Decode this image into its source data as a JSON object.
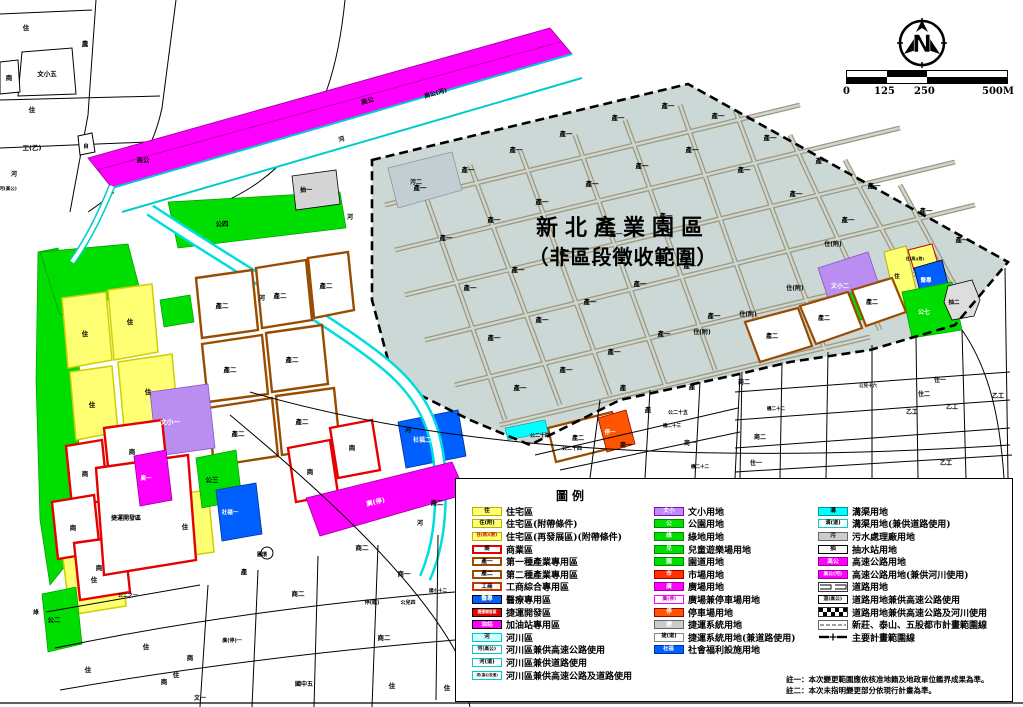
{
  "title": {
    "line1": "新北產業園區",
    "line2": "（非區段徵收範圍）"
  },
  "north_label": "N",
  "scalebar": {
    "ticks": [
      "0",
      "125",
      "250",
      "500M"
    ]
  },
  "notes": [
    "註一：本次變更範圍應依核准地籍及地政單位鑑界成果為準。",
    "註二：本次未指明變更部分依現行計畫為準。"
  ],
  "colors": {
    "residential_yellow": "#ffff73",
    "commercial_red": "#e60000",
    "industrial_brown": "#994c00",
    "park_green": "#00dd00",
    "mrt_magenta": "#ff00ff",
    "welfare_blue": "#0060ff",
    "parking_orange": "#ff5500",
    "river_cyan": "#00dddd",
    "school_purple": "#b98ef0",
    "zone_fill": "#cbd8d6",
    "grid_brown": "#a2987a"
  },
  "legend": {
    "title": "圖例",
    "columns": [
      {
        "items": [
          {
            "c": "住",
            "l": "住宅區",
            "f": "#ffff73",
            "s": "#b3b300",
            "tc": "#000",
            "cs": 6
          },
          {
            "c": "住(附)",
            "l": "住宅區(附帶條件)",
            "f": "#ffff73",
            "s": "#b3b300",
            "tc": "#000",
            "cs": 5.5
          },
          {
            "c": "住(再)(附)",
            "l": "住宅區(再發展區)(附帶條件)",
            "f": "#ffff73",
            "s": "#b3b300",
            "tc": "#c00000",
            "cs": 4.5
          },
          {
            "c": "商",
            "l": "商業區",
            "f": "#ffffff",
            "s": "#e60000",
            "tc": "#000",
            "cs": 6,
            "bw": 2
          },
          {
            "c": "產一",
            "l": "第一種產業專用區",
            "f": "#ffffff",
            "s": "#994c00",
            "tc": "#000",
            "cs": 6,
            "bw": 2
          },
          {
            "c": "產二",
            "l": "第二種產業專用區",
            "f": "#ffffff",
            "s": "#994c00",
            "tc": "#000",
            "cs": 6,
            "bw": 2
          },
          {
            "c": "工商",
            "l": "工商綜合專用區",
            "f": "#ffffff",
            "s": "#cc3300",
            "tc": "#000",
            "cs": 6,
            "bw": 2
          },
          {
            "c": "醫專",
            "l": "醫療專用區",
            "f": "#0060ff",
            "s": "#000000",
            "tc": "#fff",
            "cs": 6
          },
          {
            "c": "捷運開發區",
            "l": "捷運開發區",
            "f": "#e60000",
            "s": "#000000",
            "tc": "#fff",
            "cs": 4
          },
          {
            "c": "油站",
            "l": "加油站專用區",
            "f": "#ff00ff",
            "s": "#000000",
            "tc": "#fff",
            "cs": 6
          },
          {
            "c": "河",
            "l": "河川區",
            "f": "#ccffff",
            "s": "#00cccc",
            "tc": "#000",
            "cs": 6
          },
          {
            "c": "河(高公)",
            "l": "河川區兼供高速公路使用",
            "f": "#ffffff",
            "s": "#00cccc",
            "tc": "#000",
            "cs": 5
          },
          {
            "c": "河(道)",
            "l": "河川區兼供道路使用",
            "f": "#ffffff",
            "s": "#00cccc",
            "tc": "#000",
            "cs": 5.5
          },
          {
            "c": "河(高公及道)",
            "l": "河川區兼供高速公路及道路使用",
            "f": "#ffffff",
            "s": "#00cccc",
            "tc": "#000",
            "cs": 3.8
          }
        ]
      },
      {
        "items": [
          {
            "c": "文小",
            "l": "文小用地",
            "f": "#b98ef0",
            "s": "#8800cc",
            "tc": "#fff",
            "cs": 6
          },
          {
            "c": "公",
            "l": "公園用地",
            "f": "#00dd00",
            "s": "#008800",
            "tc": "#fff",
            "cs": 6
          },
          {
            "c": "綠",
            "l": "綠地用地",
            "f": "#00dd00",
            "s": "#008800",
            "tc": "#fff",
            "cs": 6
          },
          {
            "c": "兒",
            "l": "兒童遊樂場用地",
            "f": "#00dd00",
            "s": "#008800",
            "tc": "#fff",
            "cs": 6
          },
          {
            "c": "園",
            "l": "園道用地",
            "f": "#00dd00",
            "s": "#008800",
            "tc": "#fff",
            "cs": 6
          },
          {
            "c": "市",
            "l": "市場用地",
            "f": "#ff3300",
            "s": "#990000",
            "tc": "#fff",
            "cs": 6
          },
          {
            "c": "廣",
            "l": "廣場用地",
            "f": "#ff00ff",
            "s": "#990099",
            "tc": "#fff",
            "cs": 6
          },
          {
            "c": "廣(停)",
            "l": "廣場兼停車場用地",
            "f": "#ffffff",
            "s": "#ff00ff",
            "tc": "#cc00cc",
            "cs": 5
          },
          {
            "c": "停",
            "l": "停車場用地",
            "f": "#ff5500",
            "s": "#990000",
            "tc": "#fff",
            "cs": 6
          },
          {
            "c": "捷",
            "l": "捷運系統用地",
            "f": "#cccccc",
            "s": "#666666",
            "tc": "#fff",
            "cs": 6
          },
          {
            "c": "捷(道)",
            "l": "捷運系統用地(兼道路使用)",
            "f": "#ffffff",
            "s": "#888888",
            "tc": "#000",
            "cs": 5.5
          },
          {
            "c": "社福",
            "l": "社會福利設施用地",
            "f": "#0060ff",
            "s": "#003399",
            "tc": "#fff",
            "cs": 5.5
          }
        ]
      },
      {
        "items": [
          {
            "c": "溝",
            "l": "溝渠用地",
            "f": "#00ffff",
            "s": "#009999",
            "tc": "#000",
            "cs": 6
          },
          {
            "c": "溝(道)",
            "l": "溝渠用地(兼供道路使用)",
            "f": "#ffffff",
            "s": "#00cccc",
            "tc": "#000",
            "cs": 5.5
          },
          {
            "c": "污",
            "l": "污水處理廠用地",
            "f": "#cccccc",
            "s": "#666666",
            "tc": "#000",
            "cs": 6
          },
          {
            "c": "抽",
            "l": "抽水站用地",
            "f": "#ffffff",
            "s": "#000000",
            "tc": "#000",
            "cs": 6
          },
          {
            "c": "高公",
            "l": "高速公路用地",
            "f": "#ff00ff",
            "s": "#990099",
            "tc": "#fff",
            "cs": 6
          },
          {
            "c": "高公(河)",
            "l": "高速公路用地(兼供河川使用)",
            "f": "#ff00ff",
            "s": "#990099",
            "tc": "#fff",
            "cs": 5
          },
          {
            "type": "road",
            "l": "道路用地"
          },
          {
            "c": "道(高公)",
            "l": "道路用地兼供高速公路使用",
            "f": "#ffffff",
            "s": "#000000",
            "tc": "#000",
            "cs": 5
          },
          {
            "type": "hatch",
            "l": "道路用地兼供高速公路及河川使用"
          },
          {
            "type": "boundary-thin",
            "l": "新莊、泰山、五股都市計畫範圍線"
          },
          {
            "type": "boundary-main",
            "l": "主要計畫範圍線"
          }
        ]
      }
    ]
  },
  "map": {
    "labels": [
      {
        "t": "住",
        "x": 26,
        "y": 30
      },
      {
        "t": "農",
        "x": 85,
        "y": 46
      },
      {
        "t": "文小五",
        "x": 47,
        "y": 76
      },
      {
        "t": "商",
        "x": 9,
        "y": 80
      },
      {
        "t": "住",
        "x": 32,
        "y": 112
      },
      {
        "t": "工(乙)",
        "x": 32,
        "y": 150
      },
      {
        "t": "自",
        "x": 86,
        "y": 148,
        "s": 5.5
      },
      {
        "t": "高公",
        "x": 143,
        "y": 162
      },
      {
        "t": "河",
        "x": 14,
        "y": 176,
        "s": 6
      },
      {
        "t": "河(高公)",
        "x": 8,
        "y": 190,
        "s": 4.5
      },
      {
        "t": "高公",
        "x": 368,
        "y": 103,
        "r": -16
      },
      {
        "t": "高公(河)",
        "x": 436,
        "y": 95,
        "r": -16,
        "s": 6
      },
      {
        "t": "河",
        "x": 342,
        "y": 141,
        "r": -16,
        "s": 6
      },
      {
        "t": "河",
        "x": 350,
        "y": 219,
        "s": 6
      },
      {
        "t": "抽一",
        "x": 306,
        "y": 192,
        "s": 6
      },
      {
        "t": "污二",
        "x": 416,
        "y": 184,
        "s": 6
      },
      {
        "t": "公四",
        "x": 222,
        "y": 226
      },
      {
        "t": "河",
        "x": 262,
        "y": 300,
        "s": 6
      },
      {
        "t": "河",
        "x": 408,
        "y": 432,
        "s": 6
      },
      {
        "t": "河",
        "x": 420,
        "y": 525,
        "s": 6
      },
      {
        "t": "產一",
        "x": 420,
        "y": 190
      },
      {
        "t": "產一",
        "x": 468,
        "y": 172
      },
      {
        "t": "產一",
        "x": 516,
        "y": 152
      },
      {
        "t": "產一",
        "x": 566,
        "y": 136
      },
      {
        "t": "產一",
        "x": 618,
        "y": 120
      },
      {
        "t": "產一",
        "x": 668,
        "y": 108
      },
      {
        "t": "產一",
        "x": 718,
        "y": 118
      },
      {
        "t": "產一",
        "x": 770,
        "y": 140
      },
      {
        "t": "產一",
        "x": 822,
        "y": 163
      },
      {
        "t": "產一",
        "x": 874,
        "y": 188
      },
      {
        "t": "產一",
        "x": 926,
        "y": 213
      },
      {
        "t": "產一",
        "x": 962,
        "y": 242
      },
      {
        "t": "產一",
        "x": 446,
        "y": 240
      },
      {
        "t": "產一",
        "x": 494,
        "y": 222
      },
      {
        "t": "產一",
        "x": 542,
        "y": 204
      },
      {
        "t": "產一",
        "x": 592,
        "y": 186
      },
      {
        "t": "產一",
        "x": 642,
        "y": 168
      },
      {
        "t": "產一",
        "x": 692,
        "y": 152
      },
      {
        "t": "產一",
        "x": 744,
        "y": 172
      },
      {
        "t": "產一",
        "x": 796,
        "y": 196
      },
      {
        "t": "產一",
        "x": 848,
        "y": 222
      },
      {
        "t": "產一",
        "x": 470,
        "y": 290
      },
      {
        "t": "產一",
        "x": 518,
        "y": 272
      },
      {
        "t": "產一",
        "x": 566,
        "y": 254
      },
      {
        "t": "產一",
        "x": 616,
        "y": 236
      },
      {
        "t": "產一",
        "x": 666,
        "y": 218
      },
      {
        "t": "產一",
        "x": 494,
        "y": 340
      },
      {
        "t": "產一",
        "x": 542,
        "y": 322
      },
      {
        "t": "產一",
        "x": 590,
        "y": 304
      },
      {
        "t": "產一",
        "x": 640,
        "y": 286
      },
      {
        "t": "產一",
        "x": 690,
        "y": 268
      },
      {
        "t": "產一",
        "x": 520,
        "y": 390
      },
      {
        "t": "產一",
        "x": 566,
        "y": 372
      },
      {
        "t": "產一",
        "x": 614,
        "y": 354
      },
      {
        "t": "產一",
        "x": 664,
        "y": 336
      },
      {
        "t": "產一",
        "x": 714,
        "y": 318
      },
      {
        "t": "住(附)",
        "x": 833,
        "y": 246,
        "s": 6
      },
      {
        "t": "住(附)",
        "x": 795,
        "y": 290,
        "s": 6
      },
      {
        "t": "住(附)",
        "x": 748,
        "y": 316,
        "s": 6
      },
      {
        "t": "住(附)",
        "x": 702,
        "y": 334,
        "s": 6
      },
      {
        "t": "文小二",
        "x": 840,
        "y": 288,
        "s": 6,
        "c": "#fff"
      },
      {
        "t": "公六",
        "x": 838,
        "y": 312,
        "s": 5.5,
        "c": "#fff"
      },
      {
        "t": "住",
        "x": 897,
        "y": 278,
        "s": 5.5
      },
      {
        "t": "住(再)(附)",
        "x": 915,
        "y": 260,
        "s": 3.8
      },
      {
        "t": "醫專",
        "x": 926,
        "y": 282,
        "s": 5.5,
        "c": "#fff"
      },
      {
        "t": "公七",
        "x": 924,
        "y": 314,
        "s": 6,
        "c": "#fff"
      },
      {
        "t": "抽二",
        "x": 954,
        "y": 304,
        "s": 5.5
      },
      {
        "t": "產二",
        "x": 772,
        "y": 338,
        "s": 6
      },
      {
        "t": "產二",
        "x": 824,
        "y": 320,
        "s": 6
      },
      {
        "t": "產二",
        "x": 872,
        "y": 304,
        "s": 6
      },
      {
        "t": "產二",
        "x": 578,
        "y": 440,
        "s": 6
      },
      {
        "t": "停一",
        "x": 610,
        "y": 434,
        "s": 5.5,
        "c": "#fff"
      },
      {
        "t": "社福二",
        "x": 422,
        "y": 442,
        "s": 6,
        "c": "#fff"
      },
      {
        "t": "住",
        "x": 85,
        "y": 336
      },
      {
        "t": "住",
        "x": 130,
        "y": 324
      },
      {
        "t": "住",
        "x": 148,
        "y": 394
      },
      {
        "t": "住",
        "x": 92,
        "y": 407
      },
      {
        "t": "住",
        "x": 185,
        "y": 529
      },
      {
        "t": "住",
        "x": 94,
        "y": 582
      },
      {
        "t": "產二",
        "x": 222,
        "y": 308
      },
      {
        "t": "產二",
        "x": 280,
        "y": 298
      },
      {
        "t": "產二",
        "x": 326,
        "y": 288
      },
      {
        "t": "產二",
        "x": 230,
        "y": 372
      },
      {
        "t": "產二",
        "x": 292,
        "y": 362
      },
      {
        "t": "產二",
        "x": 238,
        "y": 436
      },
      {
        "t": "產二",
        "x": 302,
        "y": 424
      },
      {
        "t": "文小一",
        "x": 170,
        "y": 424,
        "c": "#fff"
      },
      {
        "t": "商",
        "x": 132,
        "y": 454
      },
      {
        "t": "商",
        "x": 85,
        "y": 476
      },
      {
        "t": "商",
        "x": 73,
        "y": 530
      },
      {
        "t": "商",
        "x": 99,
        "y": 570
      },
      {
        "t": "商",
        "x": 310,
        "y": 474
      },
      {
        "t": "商",
        "x": 352,
        "y": 450
      },
      {
        "t": "捷運開發區",
        "x": 126,
        "y": 520,
        "s": 6
      },
      {
        "t": "廣一",
        "x": 146,
        "y": 480,
        "s": 5.5,
        "c": "#fff"
      },
      {
        "t": "廣(停)",
        "x": 376,
        "y": 504,
        "c": "#fff",
        "r": -13
      },
      {
        "t": "公三",
        "x": 212,
        "y": 482
      },
      {
        "t": "公二",
        "x": 54,
        "y": 622
      },
      {
        "t": "社福一",
        "x": 230,
        "y": 514,
        "s": 5.5,
        "c": "#fff"
      },
      {
        "t": "圓環",
        "x": 262,
        "y": 556,
        "s": 5
      },
      {
        "t": "產",
        "x": 244,
        "y": 574
      },
      {
        "t": "商二",
        "x": 298,
        "y": 596
      },
      {
        "t": "商二",
        "x": 362,
        "y": 550
      },
      {
        "t": "商一",
        "x": 404,
        "y": 576
      },
      {
        "t": "停(臨)",
        "x": 372,
        "y": 604,
        "s": 5
      },
      {
        "t": "公兒四",
        "x": 408,
        "y": 604,
        "s": 5
      },
      {
        "t": "國小十二",
        "x": 438,
        "y": 592,
        "s": 4.5
      },
      {
        "t": "商二",
        "x": 437,
        "y": 505
      },
      {
        "t": "商二",
        "x": 384,
        "y": 640
      },
      {
        "t": "國中五",
        "x": 304,
        "y": 686,
        "s": 6
      },
      {
        "t": "住",
        "x": 392,
        "y": 688
      },
      {
        "t": "住",
        "x": 447,
        "y": 690
      },
      {
        "t": "廣(停)一",
        "x": 232,
        "y": 642,
        "s": 5
      },
      {
        "t": "公二之一",
        "x": 128,
        "y": 597,
        "s": 5
      },
      {
        "t": "住",
        "x": 88,
        "y": 672
      },
      {
        "t": "住",
        "x": 146,
        "y": 649
      },
      {
        "t": "住",
        "x": 176,
        "y": 677
      },
      {
        "t": "商",
        "x": 190,
        "y": 660
      },
      {
        "t": "商",
        "x": 164,
        "y": 684
      },
      {
        "t": "文一",
        "x": 200,
        "y": 700,
        "s": 6
      },
      {
        "t": "綠",
        "x": 36,
        "y": 614,
        "s": 5.5
      },
      {
        "t": "公二十四",
        "x": 540,
        "y": 437,
        "s": 5
      },
      {
        "t": "公二十四",
        "x": 572,
        "y": 450,
        "s": 5
      },
      {
        "t": "商一",
        "x": 626,
        "y": 447,
        "s": 6
      },
      {
        "t": "商一",
        "x": 690,
        "y": 445,
        "s": 6
      },
      {
        "t": "公二十五",
        "x": 678,
        "y": 414,
        "s": 5
      },
      {
        "t": "機二十三",
        "x": 672,
        "y": 427,
        "s": 4.5
      },
      {
        "t": "產",
        "x": 623,
        "y": 390
      },
      {
        "t": "產",
        "x": 692,
        "y": 389
      },
      {
        "t": "產",
        "x": 648,
        "y": 412
      },
      {
        "t": "商二",
        "x": 744,
        "y": 384,
        "s": 6
      },
      {
        "t": "商二",
        "x": 760,
        "y": 439,
        "s": 6
      },
      {
        "t": "機二十二",
        "x": 776,
        "y": 410,
        "s": 4.5
      },
      {
        "t": "公兒十六",
        "x": 868,
        "y": 387,
        "s": 4.5
      },
      {
        "t": "住一",
        "x": 940,
        "y": 382,
        "s": 6
      },
      {
        "t": "住二",
        "x": 924,
        "y": 396,
        "s": 6
      },
      {
        "t": "乙工",
        "x": 912,
        "y": 414,
        "s": 6
      },
      {
        "t": "乙工",
        "x": 952,
        "y": 409,
        "s": 6
      },
      {
        "t": "乙工",
        "x": 946,
        "y": 465,
        "s": 6
      },
      {
        "t": "乙工",
        "x": 998,
        "y": 398,
        "s": 6
      },
      {
        "t": "住一",
        "x": 756,
        "y": 465,
        "s": 6
      },
      {
        "t": "機二十二",
        "x": 700,
        "y": 468,
        "s": 4.5
      }
    ]
  }
}
